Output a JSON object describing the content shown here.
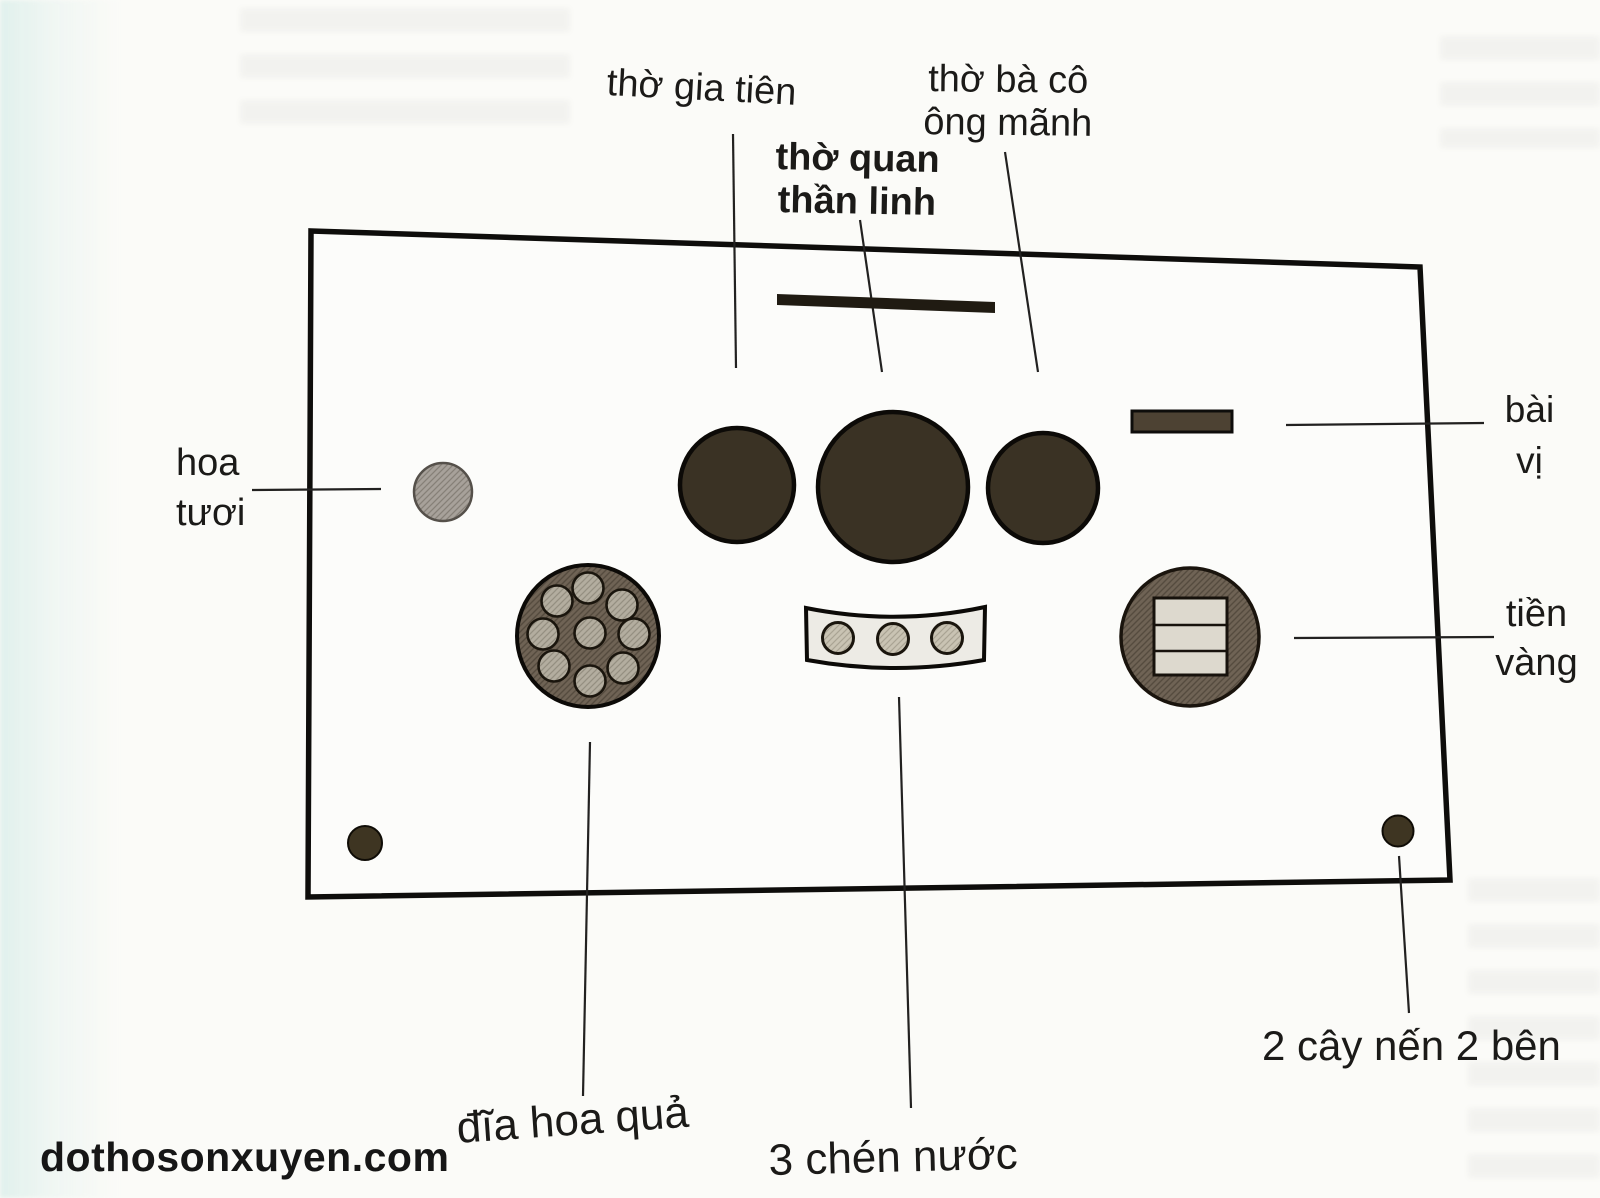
{
  "watermark": "dothosonxuyen.com",
  "labels": {
    "gia_tien": "thờ gia tiên",
    "quan_1": "thờ quan",
    "quan_2": "thần linh",
    "ba_co_1": "thờ bà cô",
    "ba_co_2": "ông mãnh",
    "bai_vi_1": "bài",
    "bai_vi_2": "vị",
    "hoa_tuoi_1": "hoa",
    "hoa_tuoi_2": "tươi",
    "tien_vang_1": "tiền",
    "tien_vang_2": "vàng",
    "dia_hoa_qua": "đĩa hoa quả",
    "chen_nuoc": "3 chén nước",
    "cay_nen": "2 cây nến 2 bên"
  },
  "colors": {
    "ink": "#1b1a18",
    "outline": "#0e0d0b",
    "bowl": "#3a3224",
    "plate": "#6f6355",
    "fruit": "#b3ad9f",
    "vase": "#a7a19a",
    "tray": "#edebe5",
    "cup": "#c9c3b3",
    "money_paper": "#ddd9ce",
    "candle": "#3e3522",
    "tablet_bar": "#201b12",
    "bai_vi_bar": "#4d4233"
  }
}
